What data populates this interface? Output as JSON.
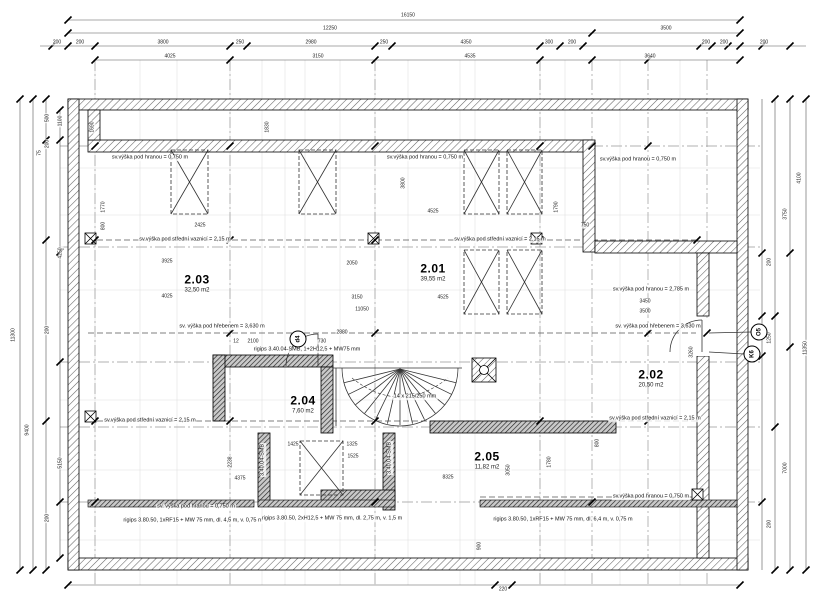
{
  "drawing": {
    "type": "floor-plan",
    "floor_label": "podkroví / attic storey",
    "units": "mm"
  },
  "rooms": [
    {
      "id": "2.01",
      "area": "39,55 m2",
      "x": 433,
      "y": 272
    },
    {
      "id": "2.02",
      "area": "20,50 m2",
      "x": 651,
      "y": 378
    },
    {
      "id": "2.03",
      "area": "32,50 m2",
      "x": 197,
      "y": 283
    },
    {
      "id": "2.04",
      "area": "7,60 m2",
      "x": 303,
      "y": 404
    },
    {
      "id": "2.05",
      "area": "11,82 m2",
      "x": 487,
      "y": 460
    }
  ],
  "annotations": [
    {
      "t": "sv.výška pod hranou = 0,750 m",
      "x": 150,
      "y": 158
    },
    {
      "t": "sv.výška pod hranou = 0,750 m",
      "x": 425,
      "y": 158
    },
    {
      "t": "sv.výška pod hranou = 0,750 m",
      "x": 638,
      "y": 160
    },
    {
      "t": "sv.výška pod hranou = 2,785 m",
      "x": 651,
      "y": 290
    },
    {
      "t": "sv. výška pod hřebenem = 3,630 m",
      "x": 222,
      "y": 327
    },
    {
      "t": "sv. výška pod hřebenem = 3,630 m",
      "x": 658,
      "y": 327
    },
    {
      "t": "sv.výška pod střední vaznicí = 2,15 m",
      "x": 185,
      "y": 240
    },
    {
      "t": "sv.výška pod střední vaznicí = 2,15 m",
      "x": 500,
      "y": 240
    },
    {
      "t": "sv.výška pod střední vaznicí = 2,15 m",
      "x": 150,
      "y": 421
    },
    {
      "t": "sv.výška pod střední vaznicí = 2,15 m",
      "x": 655,
      "y": 419
    },
    {
      "t": "sv.výška pod hranou = 0,750 m",
      "x": 651,
      "y": 497
    },
    {
      "t": "sv. výška pod hranou = 0,750 m",
      "x": 196,
      "y": 507
    },
    {
      "t": "rigips 3.40.04-SMB, 1+2H12,5 + MW75 mm",
      "x": 307,
      "y": 350
    },
    {
      "t": "14 x 215/250 mm",
      "x": 415,
      "y": 397
    },
    {
      "t": "3.40.04-SMB",
      "x": 263,
      "y": 460,
      "r": 1
    },
    {
      "t": "3.40.04-SMB",
      "x": 390,
      "y": 458,
      "r": 1
    }
  ],
  "partitions": [
    {
      "t": "rigips 3.80.50, 1xRF15 + MW 75 mm, dl. 4,5 m, v. 0,75 m",
      "x": 193,
      "y": 521
    },
    {
      "t": "rigips 3.80.50, 2xH12,5 + MW 75 mm, dl. 2,75 m, v. 1,5 m",
      "x": 332,
      "y": 519
    },
    {
      "t": "rigips 3.80.50, 1xRF15 + MW 75 mm, dl. 6,4 m, v. 0,75 m",
      "x": 563,
      "y": 520
    }
  ],
  "markers": [
    {
      "label": "O5",
      "x": 759,
      "y": 332
    },
    {
      "label": "K6",
      "x": 752,
      "y": 354
    },
    {
      "label": "d4",
      "x": 298,
      "y": 339
    }
  ],
  "dims": [
    {
      "t": "16150",
      "x": 408,
      "y": 16
    },
    {
      "t": "12250",
      "x": 330,
      "y": 29
    },
    {
      "t": "3500",
      "x": 666,
      "y": 29
    },
    {
      "t": "200",
      "x": 57,
      "y": 43
    },
    {
      "t": "200",
      "x": 80,
      "y": 43
    },
    {
      "t": "3800",
      "x": 163,
      "y": 43
    },
    {
      "t": "250",
      "x": 240,
      "y": 43
    },
    {
      "t": "2980",
      "x": 311,
      "y": 43
    },
    {
      "t": "250",
      "x": 384,
      "y": 43
    },
    {
      "t": "4350",
      "x": 466,
      "y": 43
    },
    {
      "t": "300",
      "x": 549,
      "y": 43
    },
    {
      "t": "200",
      "x": 572,
      "y": 43
    },
    {
      "t": "200",
      "x": 706,
      "y": 43
    },
    {
      "t": "200",
      "x": 724,
      "y": 43
    },
    {
      "t": "200",
      "x": 764,
      "y": 43
    },
    {
      "t": "4025",
      "x": 170,
      "y": 57
    },
    {
      "t": "3150",
      "x": 318,
      "y": 57
    },
    {
      "t": "4535",
      "x": 470,
      "y": 57
    },
    {
      "t": "3640",
      "x": 650,
      "y": 57
    },
    {
      "t": "11300",
      "x": 14,
      "y": 335,
      "r": 1
    },
    {
      "t": "9400",
      "x": 28,
      "y": 430,
      "r": 1
    },
    {
      "t": "500",
      "x": 48,
      "y": 118,
      "r": 1
    },
    {
      "t": "1100",
      "x": 61,
      "y": 121,
      "r": 1
    },
    {
      "t": "200",
      "x": 48,
      "y": 144,
      "r": 1
    },
    {
      "t": "75",
      "x": 40,
      "y": 153,
      "r": 1
    },
    {
      "t": "4250",
      "x": 61,
      "y": 253,
      "r": 1
    },
    {
      "t": "200",
      "x": 48,
      "y": 330,
      "r": 1
    },
    {
      "t": "5150",
      "x": 61,
      "y": 463,
      "r": 1
    },
    {
      "t": "200",
      "x": 48,
      "y": 518,
      "r": 1
    },
    {
      "t": "4100",
      "x": 800,
      "y": 178,
      "r": 1
    },
    {
      "t": "3750",
      "x": 786,
      "y": 214,
      "r": 1
    },
    {
      "t": "1250",
      "x": 770,
      "y": 338,
      "r": 1
    },
    {
      "t": "11350",
      "x": 806,
      "y": 348,
      "r": 1
    },
    {
      "t": "7000",
      "x": 786,
      "y": 468,
      "r": 1
    },
    {
      "t": "200",
      "x": 770,
      "y": 262,
      "r": 1
    },
    {
      "t": "200",
      "x": 770,
      "y": 524,
      "r": 1
    },
    {
      "t": "220",
      "x": 503,
      "y": 590
    },
    {
      "t": "900",
      "x": 480,
      "y": 546,
      "r": 1
    },
    {
      "t": "3925",
      "x": 167,
      "y": 262
    },
    {
      "t": "4025",
      "x": 167,
      "y": 297
    },
    {
      "t": "2425",
      "x": 200,
      "y": 226
    },
    {
      "t": "2050",
      "x": 352,
      "y": 264
    },
    {
      "t": "3150",
      "x": 357,
      "y": 298
    },
    {
      "t": "11050",
      "x": 362,
      "y": 310
    },
    {
      "t": "4525",
      "x": 433,
      "y": 212
    },
    {
      "t": "4525",
      "x": 443,
      "y": 298
    },
    {
      "t": "1770",
      "x": 104,
      "y": 207,
      "r": 1
    },
    {
      "t": "800",
      "x": 104,
      "y": 226,
      "r": 1
    },
    {
      "t": "1790",
      "x": 557,
      "y": 207,
      "r": 1
    },
    {
      "t": "750",
      "x": 585,
      "y": 226
    },
    {
      "t": "3800",
      "x": 404,
      "y": 183,
      "r": 1
    },
    {
      "t": "1830",
      "x": 268,
      "y": 127,
      "r": 1
    },
    {
      "t": "1690",
      "x": 93,
      "y": 127,
      "r": 1
    },
    {
      "t": "2880",
      "x": 342,
      "y": 333
    },
    {
      "t": "12",
      "x": 236,
      "y": 342
    },
    {
      "t": "2100",
      "x": 253,
      "y": 342
    },
    {
      "t": "730",
      "x": 322,
      "y": 342
    },
    {
      "t": "1425",
      "x": 293,
      "y": 445
    },
    {
      "t": "1325",
      "x": 352,
      "y": 445
    },
    {
      "t": "1525",
      "x": 353,
      "y": 457
    },
    {
      "t": "2238",
      "x": 231,
      "y": 462,
      "r": 1
    },
    {
      "t": "4375",
      "x": 240,
      "y": 479
    },
    {
      "t": "8325",
      "x": 448,
      "y": 478
    },
    {
      "t": "3050",
      "x": 509,
      "y": 470,
      "r": 1
    },
    {
      "t": "1780",
      "x": 550,
      "y": 462,
      "r": 1
    },
    {
      "t": "3450",
      "x": 645,
      "y": 302
    },
    {
      "t": "3500",
      "x": 645,
      "y": 312
    },
    {
      "t": "3260",
      "x": 692,
      "y": 352,
      "r": 1
    },
    {
      "t": "800",
      "x": 598,
      "y": 443,
      "r": 1
    }
  ]
}
